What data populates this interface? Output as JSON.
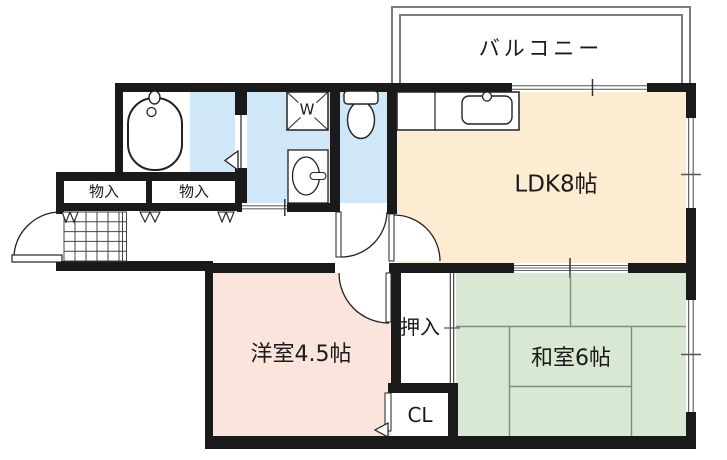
{
  "labels": {
    "balcony": "バルコニー",
    "ldk": "LDK8帖",
    "western_room": "洋室4.5帖",
    "japanese_room": "和室6帖",
    "closet_oshiire": "押入",
    "closet_cl": "CL",
    "storage_1": "物入",
    "storage_2": "物入",
    "washer": "W"
  },
  "colors": {
    "wall": "#1a1a1a",
    "ldk_floor": "#fcedd2",
    "western_room_floor": "#fae4dc",
    "japanese_room_floor": "#d9e8d2",
    "wet_area_floor": "#cfe7f6",
    "balcony_outline": "#7a7a7a",
    "tatami_line": "#7e8e7e"
  }
}
